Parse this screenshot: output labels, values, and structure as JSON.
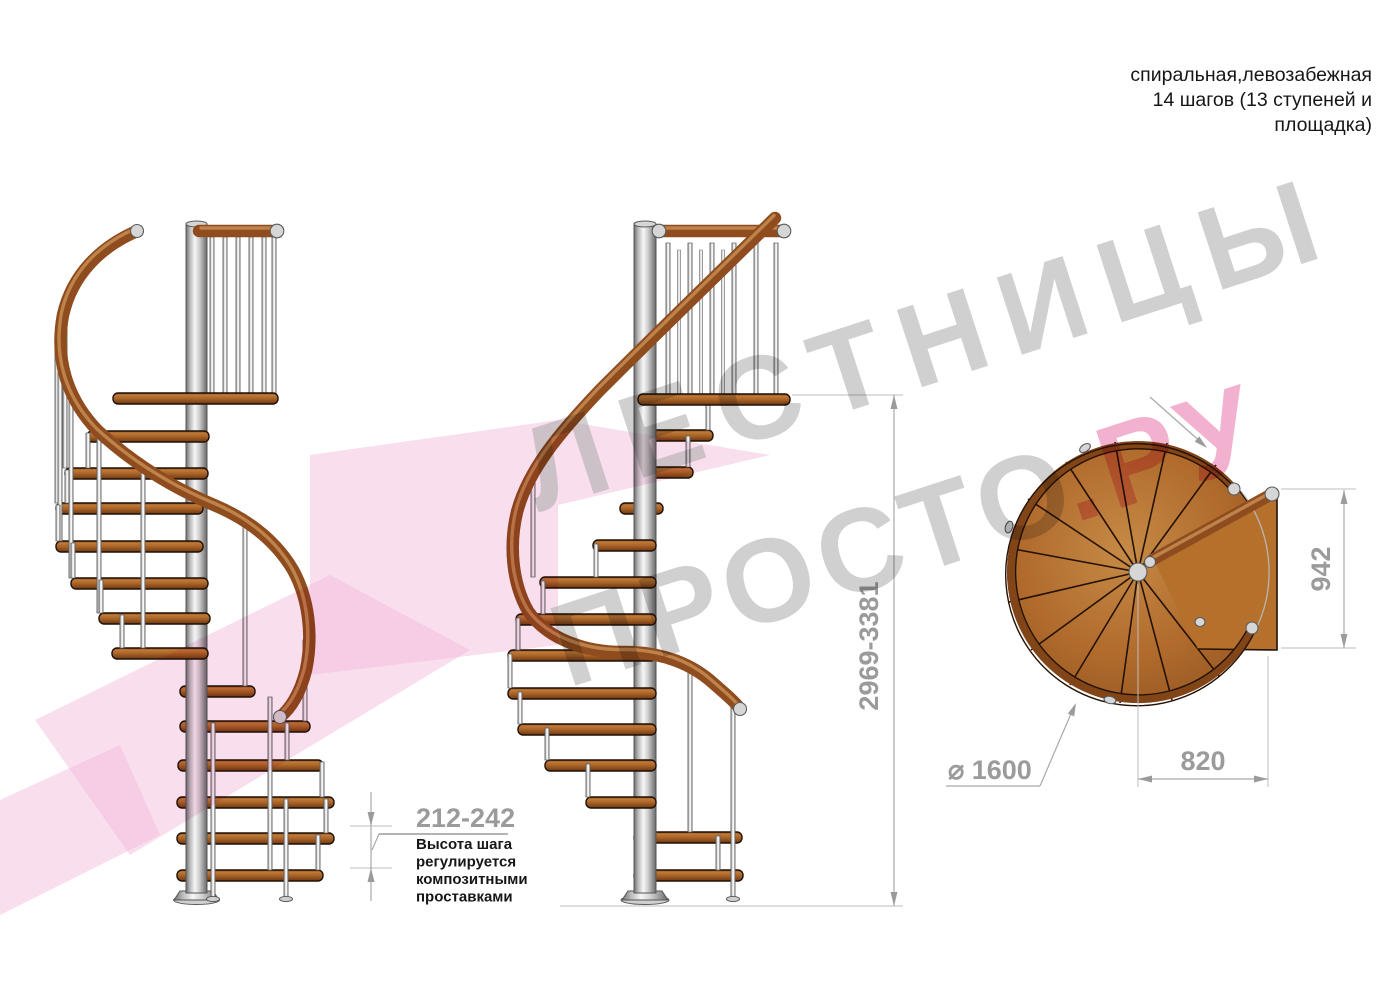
{
  "title_block": {
    "line1": "спиральная,левозабежная",
    "line2": "14 шагов (13 ступеней и",
    "line3": "площадка)"
  },
  "dimensions": {
    "total_height": "2969-3381",
    "step_height_range": "212-242",
    "landing_width": "820",
    "landing_depth": "942",
    "diameter": "⌀ 1600"
  },
  "note": {
    "line1": "Высота шага",
    "line2": "регулируется",
    "line3": "композитными",
    "line4": "проставками"
  },
  "watermark": {
    "line1": "ЛЕСТНИЦЫ",
    "line2_gray": "ПРОСТО",
    "line2_pink": ".РУ"
  },
  "colors": {
    "wood": "#b06a2c",
    "handrail": "#8f4c1e",
    "steel": "#d9d9d9",
    "dimension_gray": "#9b9b9b",
    "watermark_gray": "#a9a9a9",
    "watermark_pink": "#ef9fc3",
    "watermark_shape_pink": "#f3bddd",
    "background": "#ffffff"
  }
}
